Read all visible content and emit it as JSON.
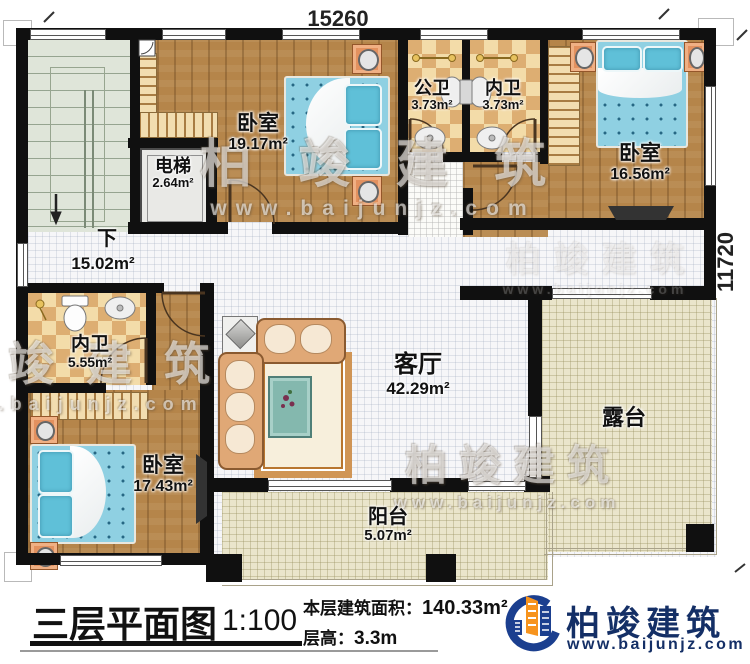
{
  "plan": {
    "dimension_top": "15260",
    "dimension_right": "11720",
    "stair_direction": "下",
    "hallway_area": "15.02m²"
  },
  "rooms": {
    "bedroom_top": {
      "name": "卧室",
      "area": "19.17m²"
    },
    "public_bath": {
      "name": "公卫",
      "area": "3.73m²"
    },
    "ensuite_top": {
      "name": "内卫",
      "area": "3.73m²"
    },
    "bedroom_right": {
      "name": "卧室",
      "area": "16.56m²"
    },
    "elevator": {
      "name": "电梯",
      "area": "2.64m²"
    },
    "ensuite_left": {
      "name": "内卫",
      "area": "5.55m²"
    },
    "bedroom_bottom": {
      "name": "卧室",
      "area": "17.43m²"
    },
    "living_room": {
      "name": "客厅",
      "area": "42.29m²"
    },
    "terrace": {
      "name": "露台"
    },
    "balcony": {
      "name": "阳台",
      "area": "5.07m²"
    }
  },
  "title_block": {
    "title": "三层平面图",
    "scale": "1:100",
    "floor_area_label": "本层建筑面积：",
    "floor_area_value": "140.33m²",
    "floor_height_label": "层高：",
    "floor_height_value": "3.3m"
  },
  "branding": {
    "company": "柏竣建筑",
    "website": "www.baijunjz.com"
  },
  "colors": {
    "wall": "#101010",
    "wood_floor": "#b5854a",
    "tile_checker": "#e8bd7e",
    "bed_blue": "#8fd0e2",
    "terrace_beige": "#eae5cb",
    "logo_blue": "#1b3f8f",
    "logo_orange": "#f7941e"
  }
}
